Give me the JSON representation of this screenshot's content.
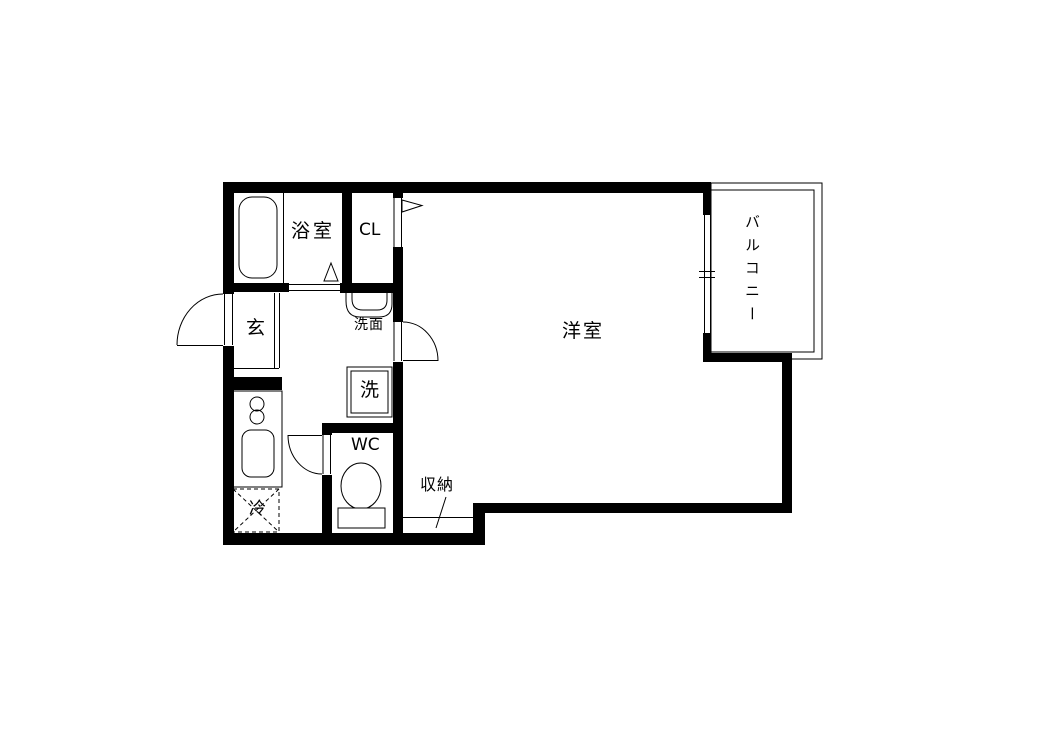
{
  "plan": {
    "type": "apartment-floor-plan",
    "labels": {
      "bathroom": "浴室",
      "closet": "CL",
      "entrance": "玄",
      "washstand": "洗面",
      "washer": "洗",
      "wc": "WC",
      "fridge": "冷",
      "storage": "収納",
      "room": "洋室",
      "balcony": "バルコニー"
    },
    "fixtures": [
      "bathtub",
      "washbasin",
      "washing-machine",
      "toilet",
      "kitchen-counter",
      "stove-burners",
      "kitchen-sink",
      "refrigerator",
      "sliding-window",
      "balcony-rail",
      "hinged-doors",
      "folding-bath-door",
      "closet-door-flag"
    ],
    "colors": {
      "line": "#000000",
      "background": "#ffffff"
    }
  }
}
